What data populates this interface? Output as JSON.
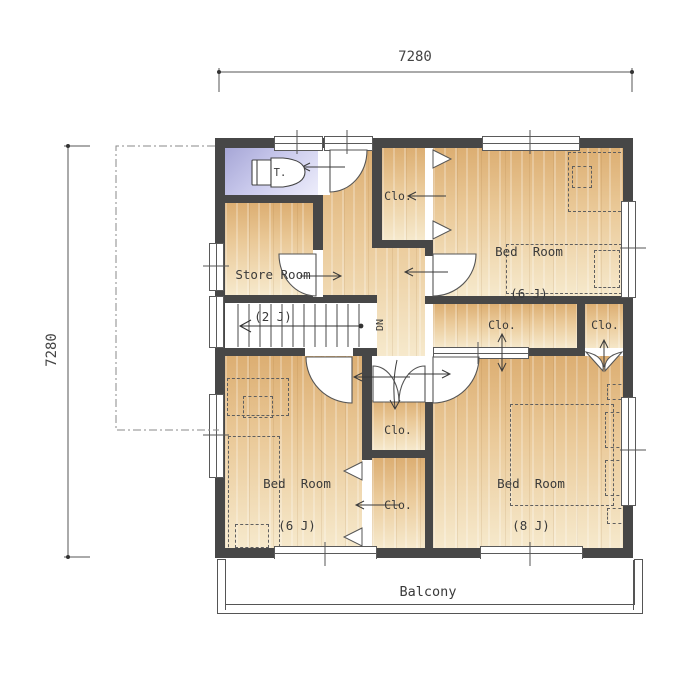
{
  "plan": {
    "type": "second-floor plan",
    "dimensions": {
      "top": "7280",
      "left": "7280"
    },
    "rooms": {
      "toilet": {
        "label": "T."
      },
      "store": {
        "name": "Store Room",
        "size": "(2 J)"
      },
      "bedroom_top_right": {
        "name": "Bed  Room",
        "size": "(6 J)"
      },
      "bedroom_bottom_left": {
        "name": "Bed  Room",
        "size": "(6 J)"
      },
      "bedroom_bottom_right": {
        "name": "Bed  Room",
        "size": "(8 J)"
      },
      "balcony": {
        "name": "Balcony"
      }
    },
    "closets": [
      {
        "id": "closet-upper-hall",
        "label": "Clo."
      },
      {
        "id": "closet-hall-wide",
        "label": "Clo."
      },
      {
        "id": "closet-hall-narrow",
        "label": "Clo."
      },
      {
        "id": "closet-center-upper",
        "label": "Clo."
      },
      {
        "id": "closet-center-lower",
        "label": "Clo."
      }
    ],
    "stairs": {
      "direction": "DN"
    }
  },
  "colors": {
    "wall": "#474747",
    "wood_dark": "#dcae72",
    "wood_light": "#f6e9cc",
    "toilet_dark": "#a6a6d6",
    "line": "#555555"
  }
}
